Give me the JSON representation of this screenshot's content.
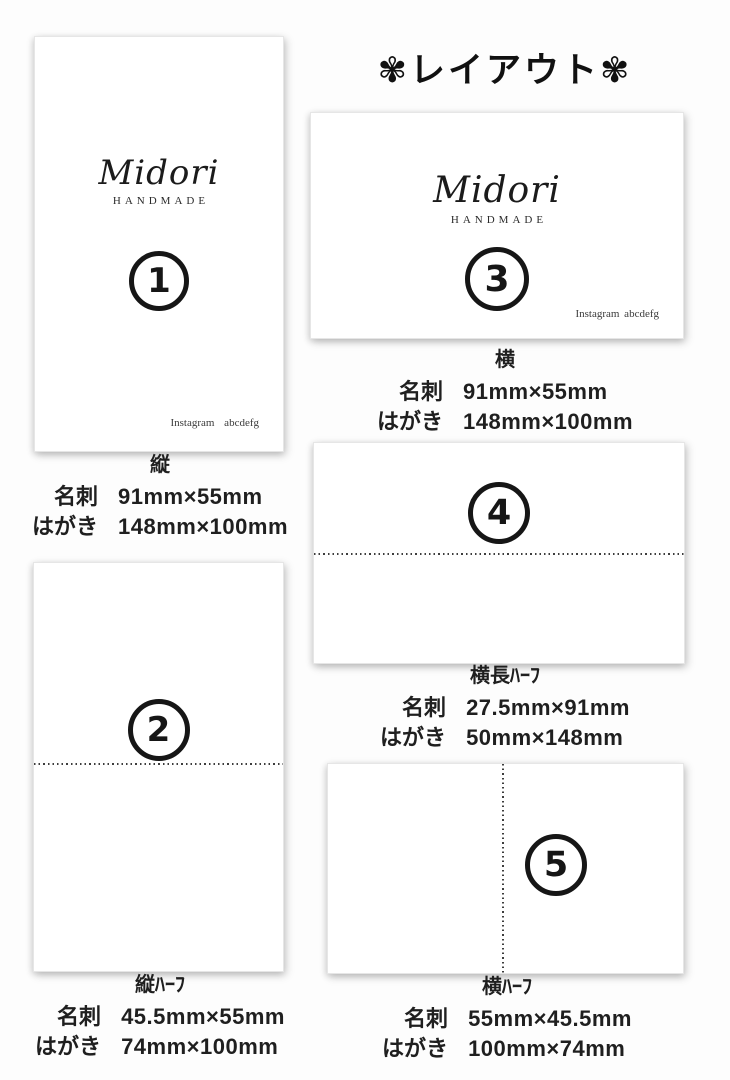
{
  "page": {
    "title": "✾レイアウト✾",
    "background": "#fdfdfd",
    "ink_color": "#1f1f1f"
  },
  "brand": {
    "logo": "Midori",
    "sub": "HANDMADE",
    "instagram": "Instagram abcdefg"
  },
  "labels": {
    "meishi": "名刺",
    "hagaki": "はがき"
  },
  "layouts": [
    {
      "number": "1",
      "label": "縦",
      "orientation": "vertical",
      "meishi": "91mm×55mm",
      "hagaki": "148mm×100mm",
      "fold_line": "none"
    },
    {
      "number": "2",
      "label": "縦ﾊｰﾌ",
      "orientation": "vertical",
      "meishi": "45.5mm×55mm",
      "hagaki": "74mm×100mm",
      "fold_line": "horizontal"
    },
    {
      "number": "3",
      "label": "横",
      "orientation": "horizontal",
      "meishi": "91mm×55mm",
      "hagaki": "148mm×100mm",
      "fold_line": "none"
    },
    {
      "number": "4",
      "label": "横長ﾊｰﾌ",
      "orientation": "horizontal",
      "meishi": "27.5mm×91mm",
      "hagaki": "50mm×148mm",
      "fold_line": "horizontal"
    },
    {
      "number": "5",
      "label": "横ﾊｰﾌ",
      "orientation": "horizontal",
      "meishi": "55mm×45.5mm",
      "hagaki": "100mm×74mm",
      "fold_line": "vertical"
    }
  ]
}
